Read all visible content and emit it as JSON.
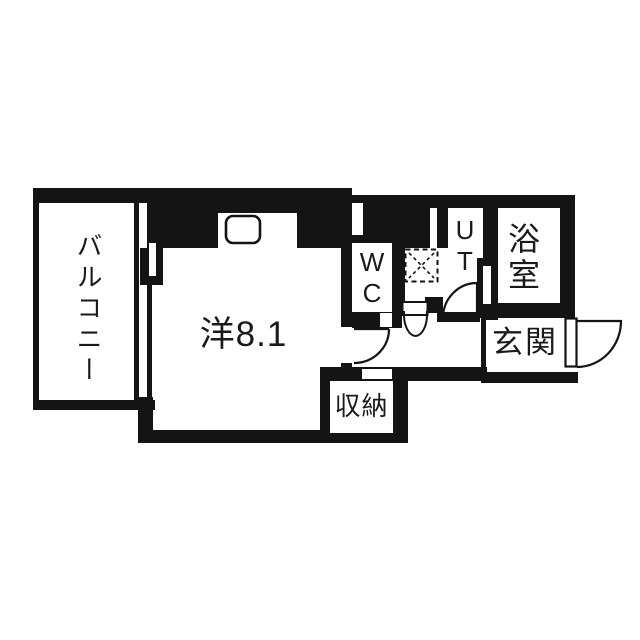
{
  "floorplan": {
    "rooms": {
      "balcony": {
        "label": "バルコニー"
      },
      "western_room": {
        "label": "洋8.1"
      },
      "wc": {
        "label": "WC"
      },
      "utility": {
        "label": "UT"
      },
      "bathroom": {
        "label": "浴室"
      },
      "entrance": {
        "label": "玄関"
      },
      "storage": {
        "label": "収納"
      }
    },
    "colors": {
      "wall": "#141414",
      "floor": "#ffffff"
    }
  }
}
